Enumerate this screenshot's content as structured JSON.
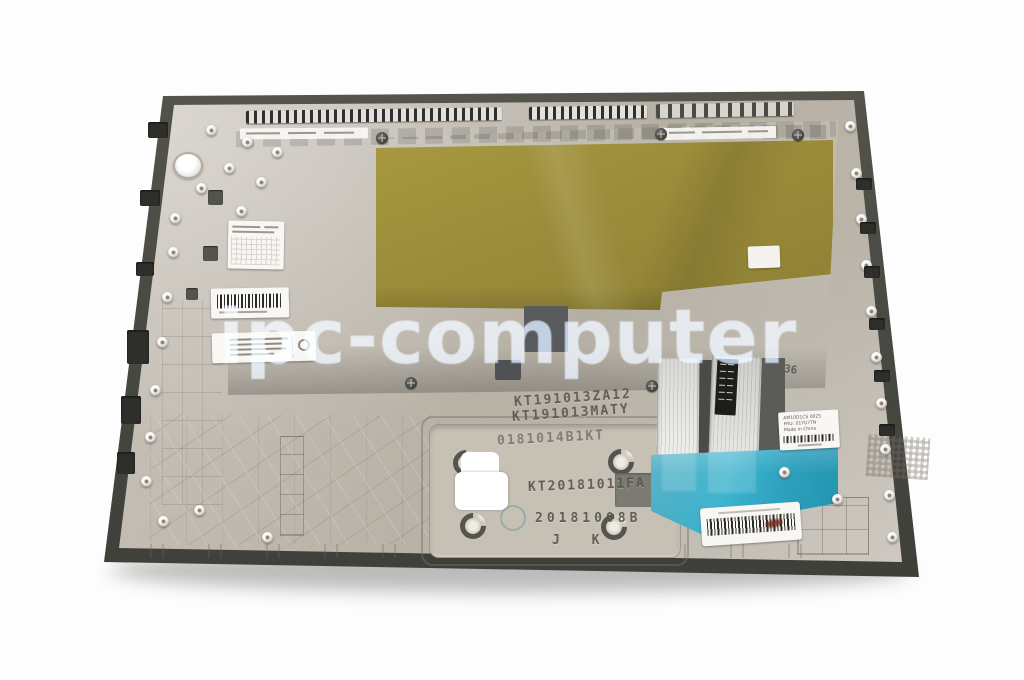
{
  "watermark_text": "ipc-computer",
  "stamps": {
    "kb_code_1": "KT191013ZA12",
    "kb_code_2": "KT191013MATY",
    "case_code_1": "0181014B1KT",
    "case_code_2": "KT20181011FA",
    "case_code_3": "20181008B",
    "case_code_4": "J K",
    "mold_mark": "36"
  },
  "labels": {
    "fru": {
      "line1": "AM10D1CS 002S",
      "line2": "FRU: 01YU7TN",
      "line3": "Made in China"
    }
  },
  "colors": {
    "background": "#fdfdfd",
    "case_rim": "#4b4b45",
    "case_body": "#bfb9ad",
    "keyboard_plate": "#67686c",
    "mylar_shield": "#9b8c3a",
    "adhesive_tape": "#2fa6c0",
    "watermark": "#b9d2ec"
  }
}
